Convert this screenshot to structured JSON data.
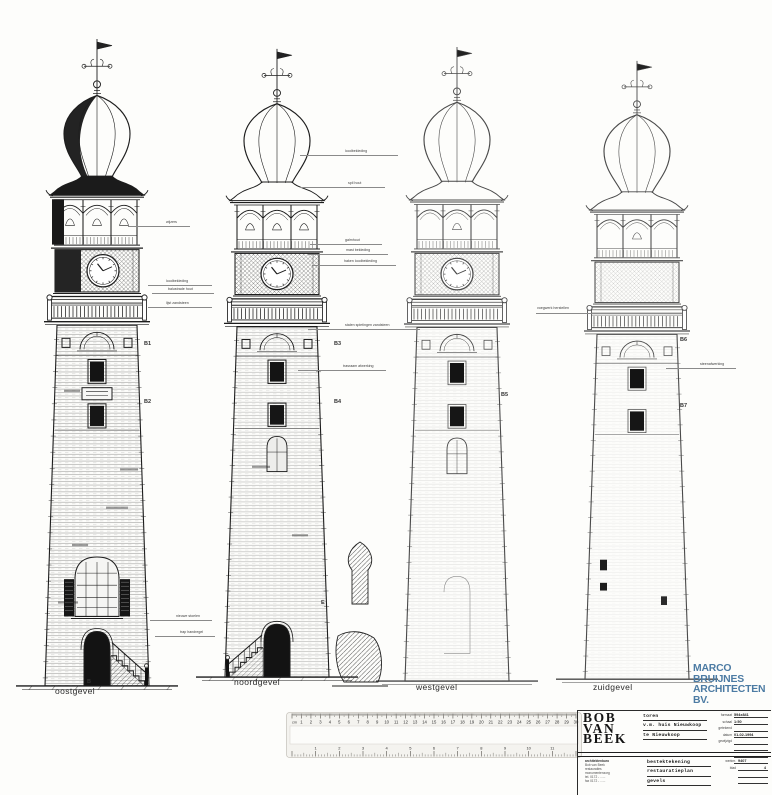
{
  "sheet": {
    "background": "#fdfdfb"
  },
  "drawing": {
    "towers": [
      {
        "key": 1,
        "name": "oostgevel",
        "left": 2,
        "top": 35,
        "height": 655,
        "brick": 0.5,
        "trellis": 0.8,
        "dark": true,
        "clock": true,
        "clock_dx": 6,
        "plaque": true,
        "bigwin": true,
        "door": true,
        "steps": "right",
        "smudges": [
          [
            62,
            352,
            16
          ],
          [
            104,
            468,
            22
          ],
          [
            70,
            505,
            16
          ],
          [
            56,
            562,
            20
          ],
          [
            118,
            430,
            18
          ]
        ]
      },
      {
        "key": 2,
        "name": "noordgevel",
        "left": 182,
        "top": 45,
        "height": 636,
        "brick": 0.4,
        "trellis": 0.8,
        "clock": true,
        "clock_dx": 0,
        "midarch": true,
        "door": true,
        "steps": "left",
        "smudges": [
          [
            70,
            430,
            18
          ],
          [
            110,
            500,
            16
          ]
        ]
      },
      {
        "key": 3,
        "name": "westgevel",
        "left": 362,
        "top": 43,
        "height": 642,
        "brick": 0.16,
        "trellis": 0.45,
        "clock": true,
        "clock_dx": 0,
        "midarch": true,
        "faint": true,
        "faintdoor": true
      },
      {
        "key": 4,
        "name": "zuidgevel",
        "left": 542,
        "top": 57,
        "height": 626,
        "brick": 0.1,
        "trellis": 0.3,
        "clock": false,
        "faint": true,
        "marks": true
      }
    ],
    "detail_cut": {
      "x": 330,
      "y": 540,
      "w": 60,
      "h": 152
    },
    "elevation_labels": [
      {
        "text": "oostgevel",
        "x": 55,
        "y": 686
      },
      {
        "text": "noordgevel",
        "x": 234,
        "y": 677
      },
      {
        "text": "westgevel",
        "x": 416,
        "y": 682
      },
      {
        "text": "zuidgevel",
        "x": 593,
        "y": 682
      }
    ],
    "markers": [
      {
        "text": "B",
        "x": 87,
        "y": 679
      },
      {
        "text": "E",
        "x": 321,
        "y": 600
      },
      {
        "text": "B1",
        "x": 144,
        "y": 341
      },
      {
        "text": "B2",
        "x": 144,
        "y": 399
      },
      {
        "text": "B3",
        "x": 334,
        "y": 341
      },
      {
        "text": "B4",
        "x": 334,
        "y": 399
      },
      {
        "text": "B5",
        "x": 501,
        "y": 392
      },
      {
        "text": "B6",
        "x": 680,
        "y": 337
      },
      {
        "text": "B7",
        "x": 680,
        "y": 403
      }
    ],
    "annotations": [
      {
        "text": "wijzers",
        "tx": 166,
        "ty": 220,
        "lx": 128,
        "lw": 62,
        "ly": 226
      },
      {
        "text": "loodbekleding",
        "tx": 166,
        "ty": 279,
        "lx": 148,
        "lw": 64,
        "ly": 285
      },
      {
        "text": "balustrade hout",
        "tx": 168,
        "ty": 287,
        "lx": 152,
        "lw": 62,
        "ly": 293
      },
      {
        "text": "lijst zandsteen",
        "tx": 166,
        "ty": 301,
        "lx": 148,
        "lw": 64,
        "ly": 307
      },
      {
        "text": "nieuwe stoelen",
        "tx": 176,
        "ty": 614,
        "lx": 150,
        "lw": 62,
        "ly": 620
      },
      {
        "text": "trap handregel",
        "tx": 180,
        "ty": 630,
        "lx": 155,
        "lw": 60,
        "ly": 636
      },
      {
        "text": "loodbekleding",
        "tx": 345,
        "ty": 149,
        "lx": 300,
        "lw": 98,
        "ly": 155
      },
      {
        "text": "spil hout",
        "tx": 348,
        "ty": 181,
        "lx": 300,
        "lw": 85,
        "ly": 187
      },
      {
        "text": "galmhout",
        "tx": 345,
        "ty": 238,
        "lx": 310,
        "lw": 72,
        "ly": 244
      },
      {
        "text": "mast bekleding",
        "tx": 346,
        "ty": 248,
        "lx": 308,
        "lw": 80,
        "ly": 254
      },
      {
        "text": "haken loodbekleding",
        "tx": 344,
        "ty": 259,
        "lx": 312,
        "lw": 84,
        "ly": 265
      },
      {
        "text": "stalen spietingen zandsteen",
        "tx": 345,
        "ty": 323,
        "lx": 308,
        "lw": 112,
        "ly": 329
      },
      {
        "text": "trasraam afwerking",
        "tx": 343,
        "ty": 364,
        "lx": 298,
        "lw": 88,
        "ly": 370
      },
      {
        "text": "voegwerk herstellen",
        "tx": 537,
        "ty": 306,
        "lx": 536,
        "lw": 62,
        "ly": 313
      },
      {
        "text": "steenafwerking",
        "tx": 700,
        "ty": 362,
        "lx": 666,
        "lw": 70,
        "ly": 368
      }
    ]
  },
  "ruler": {
    "top_unit": "cm",
    "top_count": 30,
    "bottom_count": 12
  },
  "title_block": {
    "logo": [
      "BOB",
      "VAN",
      "BEEK"
    ],
    "address_lines": [
      "architektenburo",
      "Bob van Beek",
      "restauraties",
      "monumentenzorg",
      "tel. 0172 - ......",
      "fax 0172 - ......"
    ],
    "project": [
      "toren",
      "v.m. huis Nieuwkoop",
      "te Nieuwkoop"
    ],
    "subject": [
      "bestektekening",
      "restauratieplan",
      "gevels"
    ],
    "fields": [
      {
        "label": "formaat",
        "value": "594x841"
      },
      {
        "label": "schaal",
        "value": "1:50"
      },
      {
        "label": "getekend",
        "value": ""
      },
      {
        "label": "datum",
        "value": "01-02-1994"
      },
      {
        "label": "gewijzigd",
        "value": ""
      }
    ],
    "fields2": [
      {
        "label": "werknr.",
        "value": "9407",
        "align": "left"
      },
      {
        "label": "blad",
        "value": "4",
        "align": "right"
      }
    ]
  },
  "stamp": {
    "lines": [
      "MARCO",
      "BRUIJNES",
      "ARCHITECTEN",
      "BV."
    ],
    "color": "#4c7ba3"
  }
}
